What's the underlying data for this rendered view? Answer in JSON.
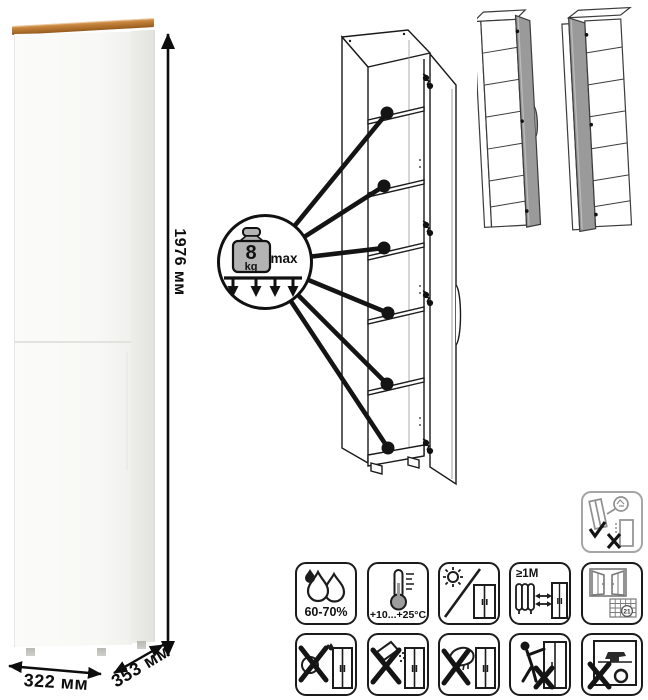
{
  "dimensions": {
    "height": "1976 мм",
    "width": "322 мм",
    "depth": "353 мм"
  },
  "load_limit": {
    "value": "8",
    "unit": "kg",
    "qualifier": "max"
  },
  "care": {
    "humidity": "60-70%",
    "temperature": "+10...+25°C",
    "distance": "≥1M",
    "calendar_day": "21"
  }
}
